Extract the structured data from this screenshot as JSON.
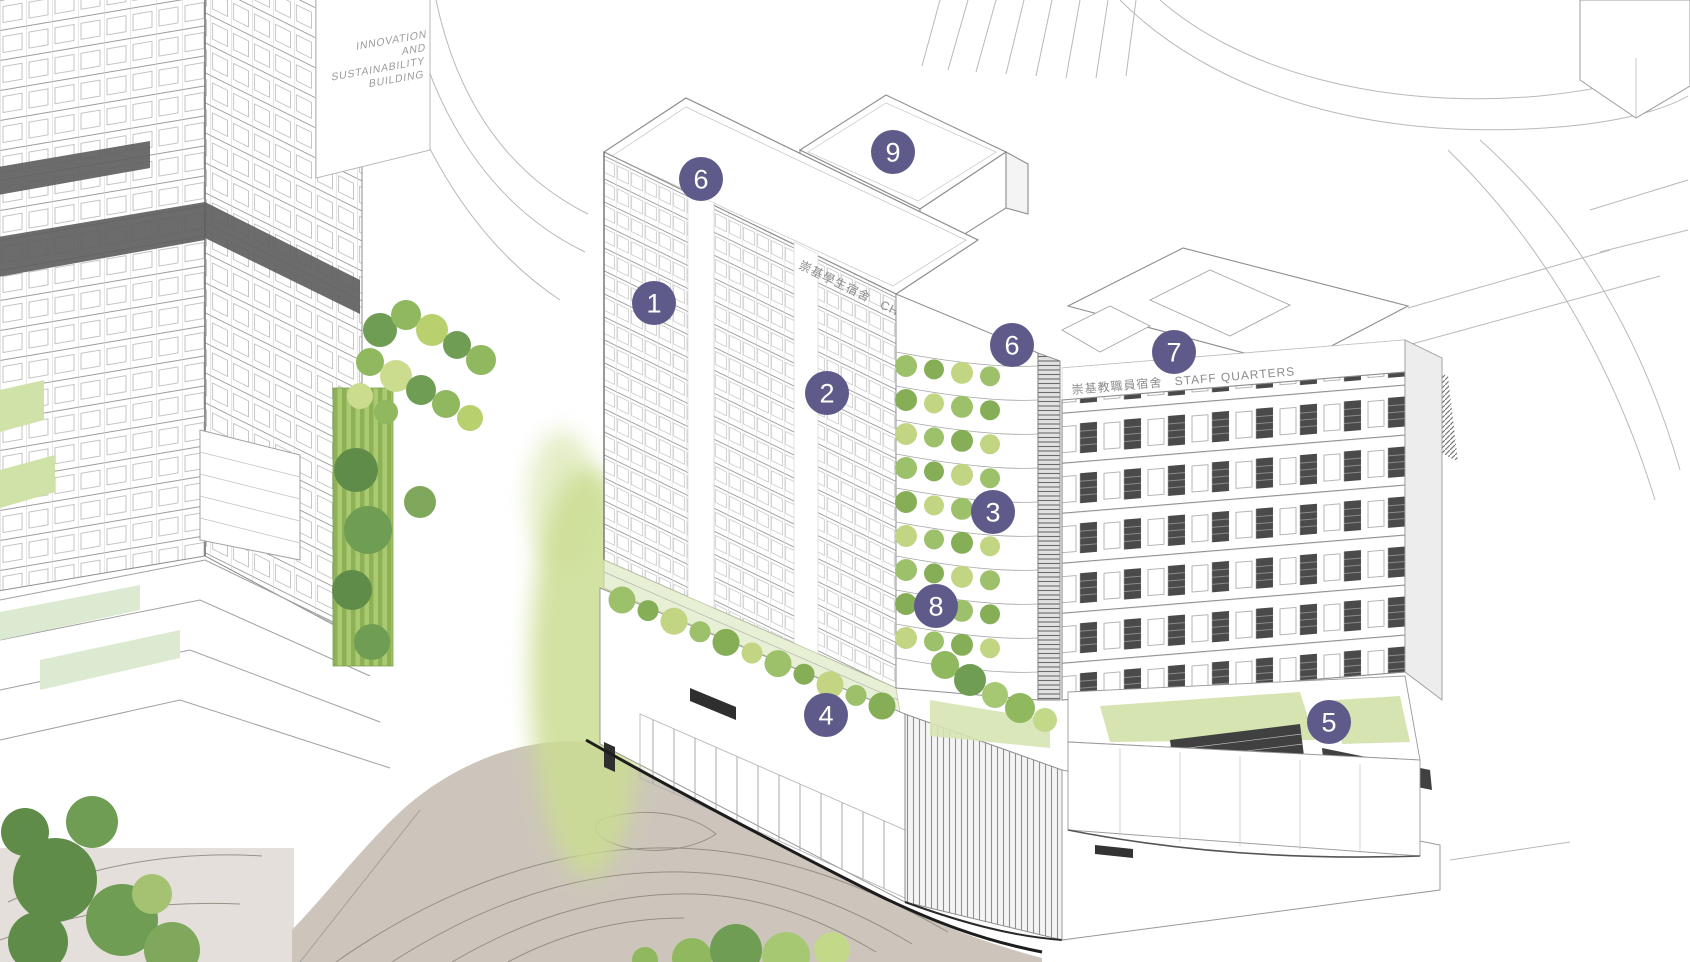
{
  "scene": {
    "description": "Axonometric architectural illustration of a campus redevelopment with numbered key markers",
    "background": "#ffffff"
  },
  "labels": {
    "innovation_building": {
      "lines": [
        "INNOVATION",
        "AND",
        "SUSTAINABILITY",
        "BUILDING"
      ]
    },
    "chung_chi_hall": {
      "zh": "崇基學生宿舍",
      "en": "CHUNG CHI HALL"
    },
    "staff_quarters": {
      "zh": "崇基教職員宿舍",
      "en": "STAFF QUARTERS"
    }
  },
  "markers": [
    {
      "label": "6",
      "x": 701,
      "y": 179
    },
    {
      "label": "9",
      "x": 893,
      "y": 152
    },
    {
      "label": "1",
      "x": 654,
      "y": 303
    },
    {
      "label": "2",
      "x": 827,
      "y": 393
    },
    {
      "label": "6",
      "x": 1012,
      "y": 345
    },
    {
      "label": "7",
      "x": 1174,
      "y": 352
    },
    {
      "label": "3",
      "x": 993,
      "y": 512
    },
    {
      "label": "8",
      "x": 936,
      "y": 606
    },
    {
      "label": "4",
      "x": 826,
      "y": 715
    },
    {
      "label": "5",
      "x": 1329,
      "y": 722
    }
  ],
  "colors": {
    "marker_fill": "#5e5b8a",
    "marker_text": "#ffffff",
    "line_work": "#9a9a9a",
    "tree_green_dark": "#5f8c49",
    "tree_green": "#8fb85f",
    "tree_green_light": "#b8d06e",
    "tree_yellow_green": "#ccdc8f",
    "lawn": "#d6e4b2",
    "glow_green": "#cbdd92",
    "plaza": "#cdc5bb",
    "contour": "#8d857b",
    "dark_fill": "#3e3e3e"
  }
}
